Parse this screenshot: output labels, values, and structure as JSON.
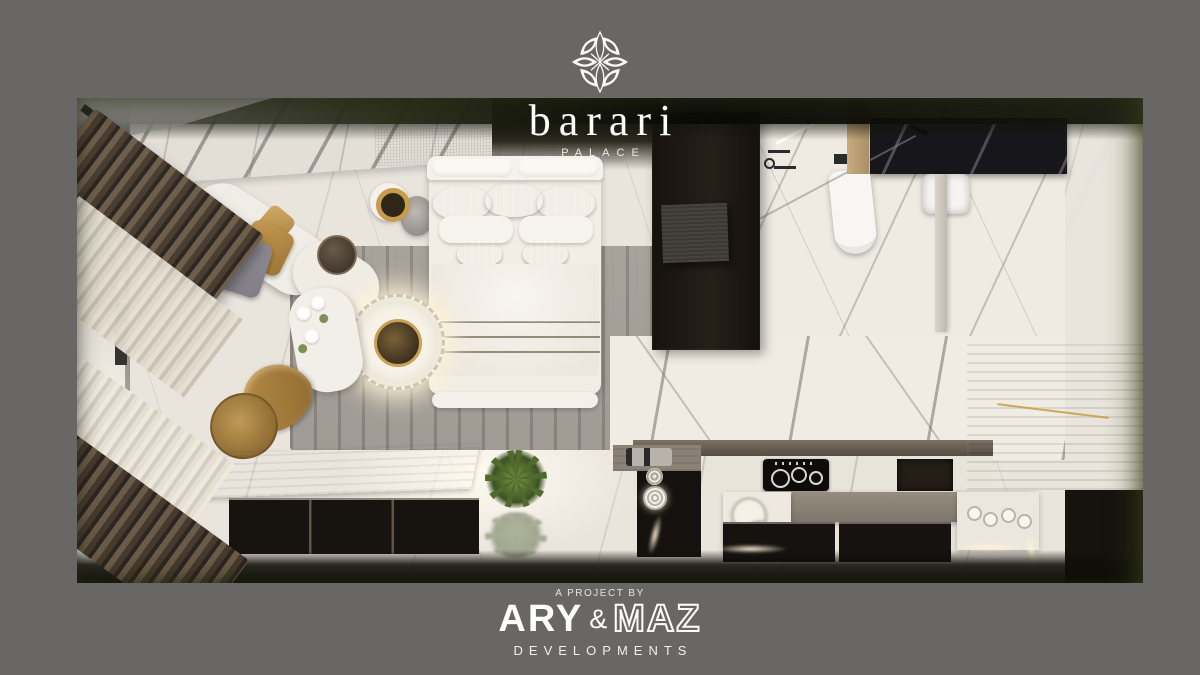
{
  "page": {
    "background_color": "#696766"
  },
  "brand": {
    "icon": "barari-flower-icon",
    "name": "barari",
    "subtitle": "PALACE"
  },
  "footer": {
    "tagline": "A PROJECT BY",
    "developer": {
      "part1": "ARY",
      "amp": "&",
      "part2": "MAZ",
      "suffix": "DEVELOPMENTS"
    }
  },
  "scene": {
    "type": "top-down-3d-render-of-furnished-studio-apartment",
    "rooms": [
      "bedroom-living-area",
      "wardrobe-corridor",
      "bathroom",
      "kitchen"
    ],
    "colors": {
      "marble_floor": "#e9e4dc",
      "dark_wood": "#1d1814",
      "gray_wood": "#7a7164",
      "gold_accent": "#c9a24a",
      "bronze_textile": "#b08443",
      "led_glow": "#fff3d8",
      "olive_vignette": "#3a441c",
      "curtain_brown": "#4a3e30",
      "curtain_sheer": "#ded7c9"
    }
  }
}
